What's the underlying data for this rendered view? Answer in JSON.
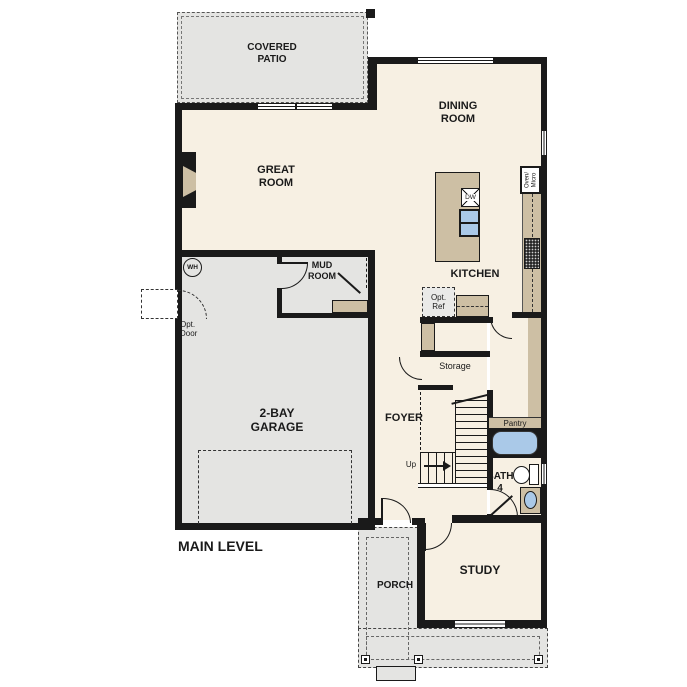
{
  "plan": {
    "title": "MAIN LEVEL",
    "rooms": {
      "covered_patio": "COVERED\nPATIO",
      "dining_room": "DINING\nROOM",
      "great_room": "GREAT\nROOM",
      "kitchen": "KITCHEN",
      "mud_room": "MUD\nROOM",
      "garage": "2-BAY\nGARAGE",
      "foyer": "FOYER",
      "storage": "Storage",
      "pantry": "Pantry",
      "bath": "BATH",
      "bath_number": "4",
      "study": "STUDY",
      "porch": "PORCH"
    },
    "fixtures": {
      "water_heater": "WH",
      "opt_door": "Opt.\nDoor",
      "opt_ref": "Opt.\nRef",
      "oven_micro": "Oven/\nMicro",
      "dishwasher": "DW",
      "up": "Up"
    },
    "colors": {
      "room_fill": "#f7f0e3",
      "exterior_fill": "#e4e4e2",
      "counter_fill": "#cdbfa4",
      "water_fill": "#aac9e8",
      "wall": "#1a1a1a"
    }
  }
}
